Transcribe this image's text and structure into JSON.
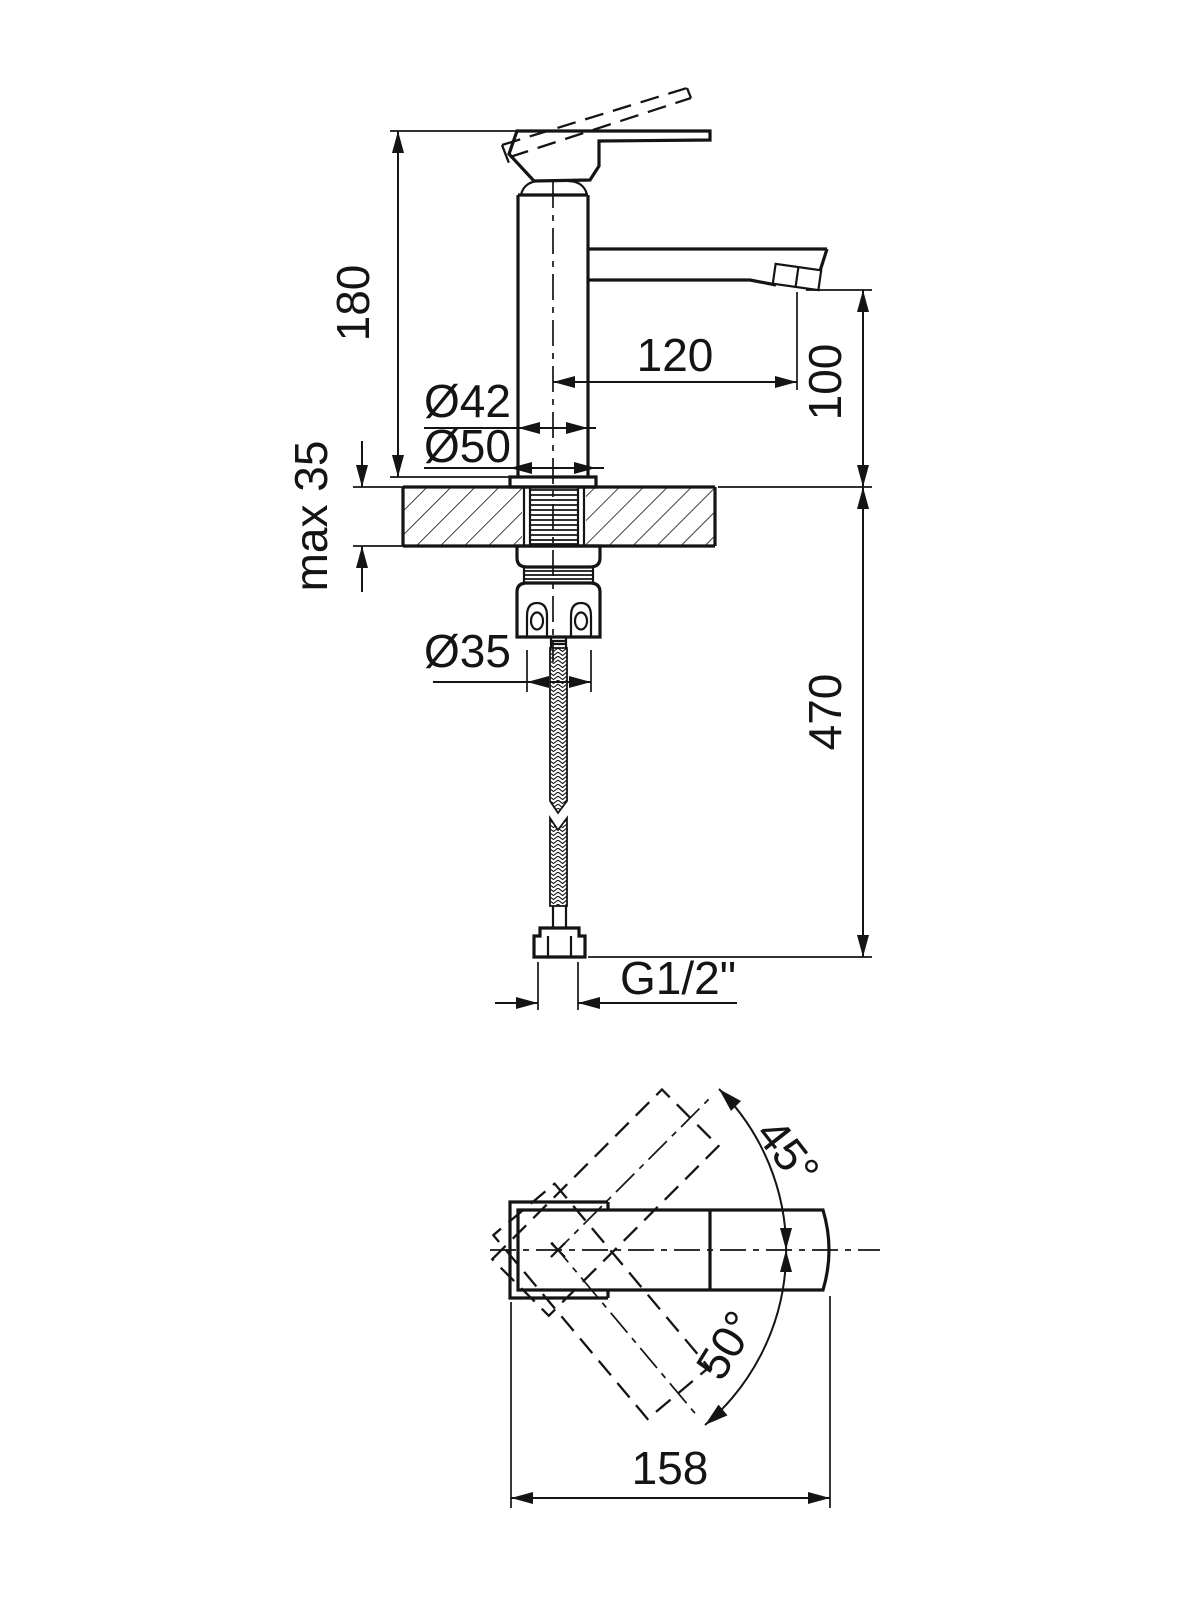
{
  "drawing": {
    "side_view": {
      "dims": {
        "height": "180",
        "max_thickness": "max 35",
        "body_diameter": "Ø42",
        "base_diameter": "Ø50",
        "spout_reach": "120",
        "spout_height": "100",
        "shank_diameter": "Ø35",
        "hose_length": "470",
        "thread": "G1/2\""
      }
    },
    "plan_view": {
      "dims": {
        "handle_angle_up": "45°",
        "handle_angle_down": "50°",
        "overall_length": "158"
      }
    },
    "line_color": "#141414",
    "background_color": "#ffffff"
  }
}
